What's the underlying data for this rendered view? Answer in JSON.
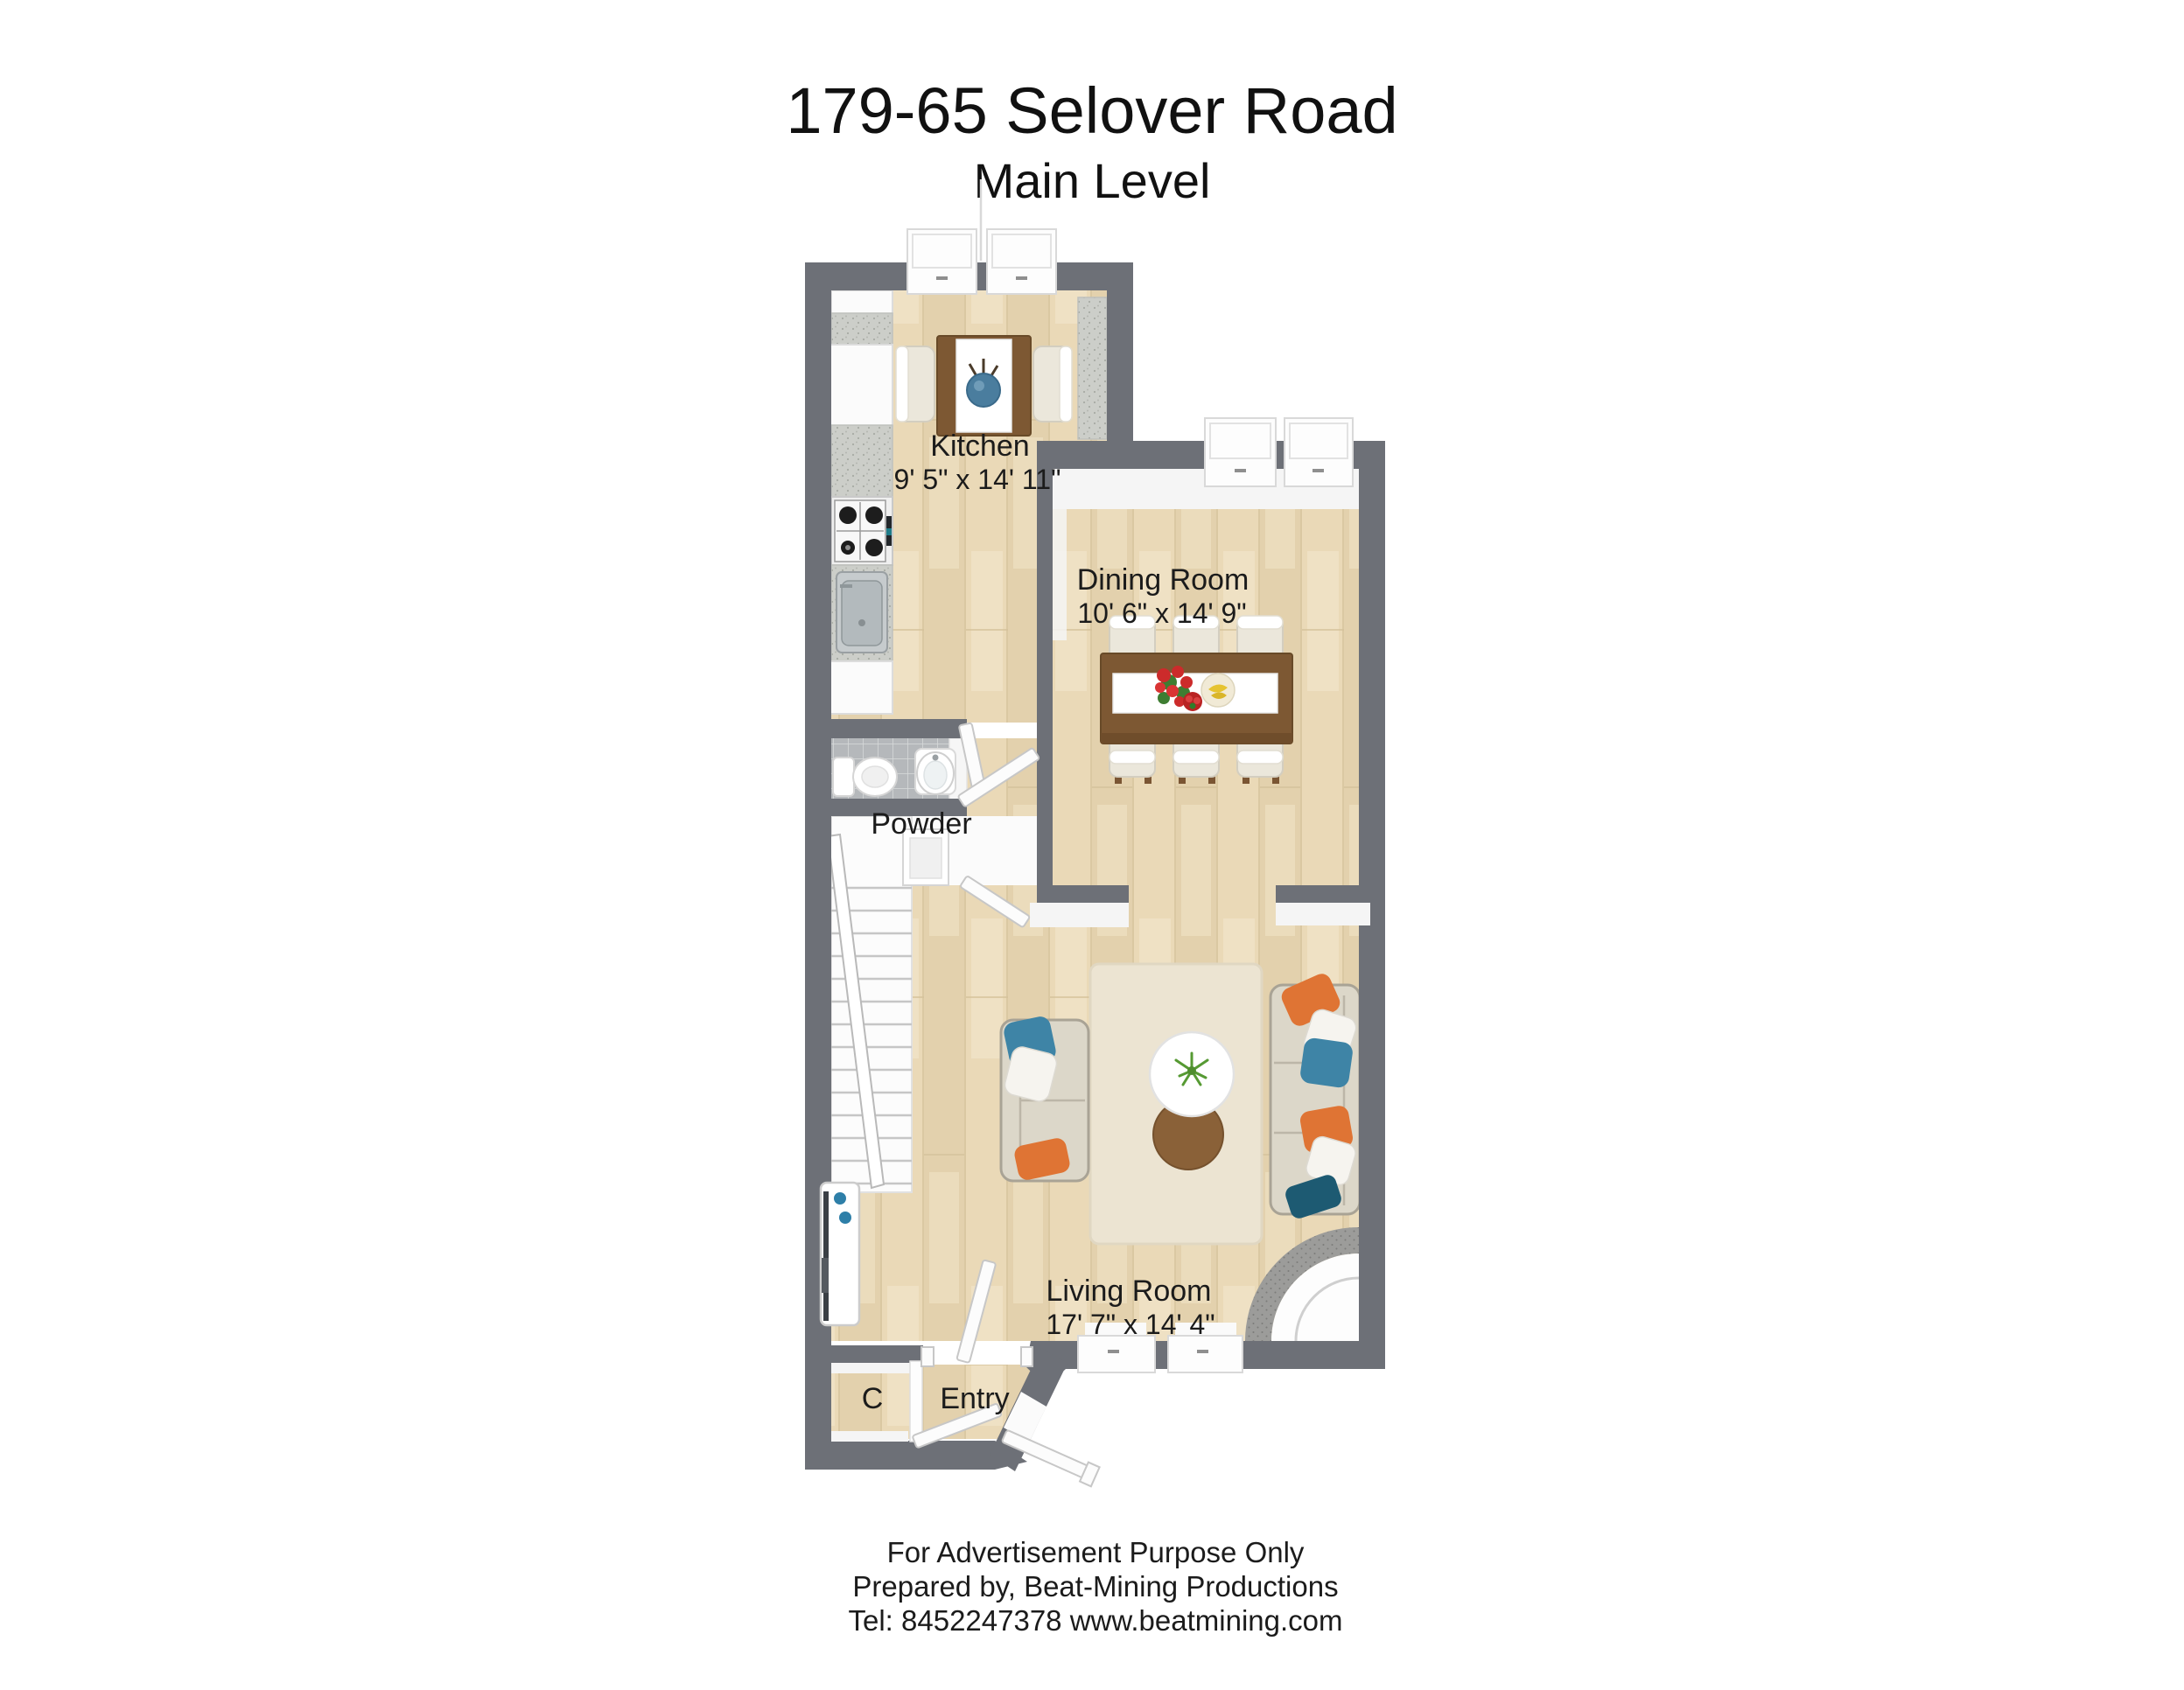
{
  "title": {
    "address": "179-65 Selover Road",
    "level": "Main Level"
  },
  "rooms": {
    "kitchen": {
      "label": "Kitchen",
      "dimensions": "9' 5\" x 14' 11\""
    },
    "dining_room": {
      "label": "Dining Room",
      "dimensions": "10' 6\" x 14' 9\""
    },
    "powder_room": {
      "label": "Powder"
    },
    "living_room": {
      "label": "Living Room",
      "dimensions": "17' 7\" x 14' 4\""
    },
    "closet": {
      "label": "C"
    },
    "entry": {
      "label": "Entry"
    }
  },
  "footer": {
    "line1": "For Advertisement Purpose Only",
    "line2": "Prepared by, Beat-Mining Productions",
    "line3": "Tel: 8452247378 www.beatmining.com"
  },
  "colors": {
    "wall_gray": "#6d7077",
    "wood_floor": "#ead9b7",
    "powder_tile": "#b5b8bb",
    "furniture_wood": "#7d5833",
    "pillow_orange": "#df7434",
    "pillow_blue": "#3e84a6",
    "pillow_teal": "#1d5a72",
    "rug_cream": "#ece4d2"
  }
}
